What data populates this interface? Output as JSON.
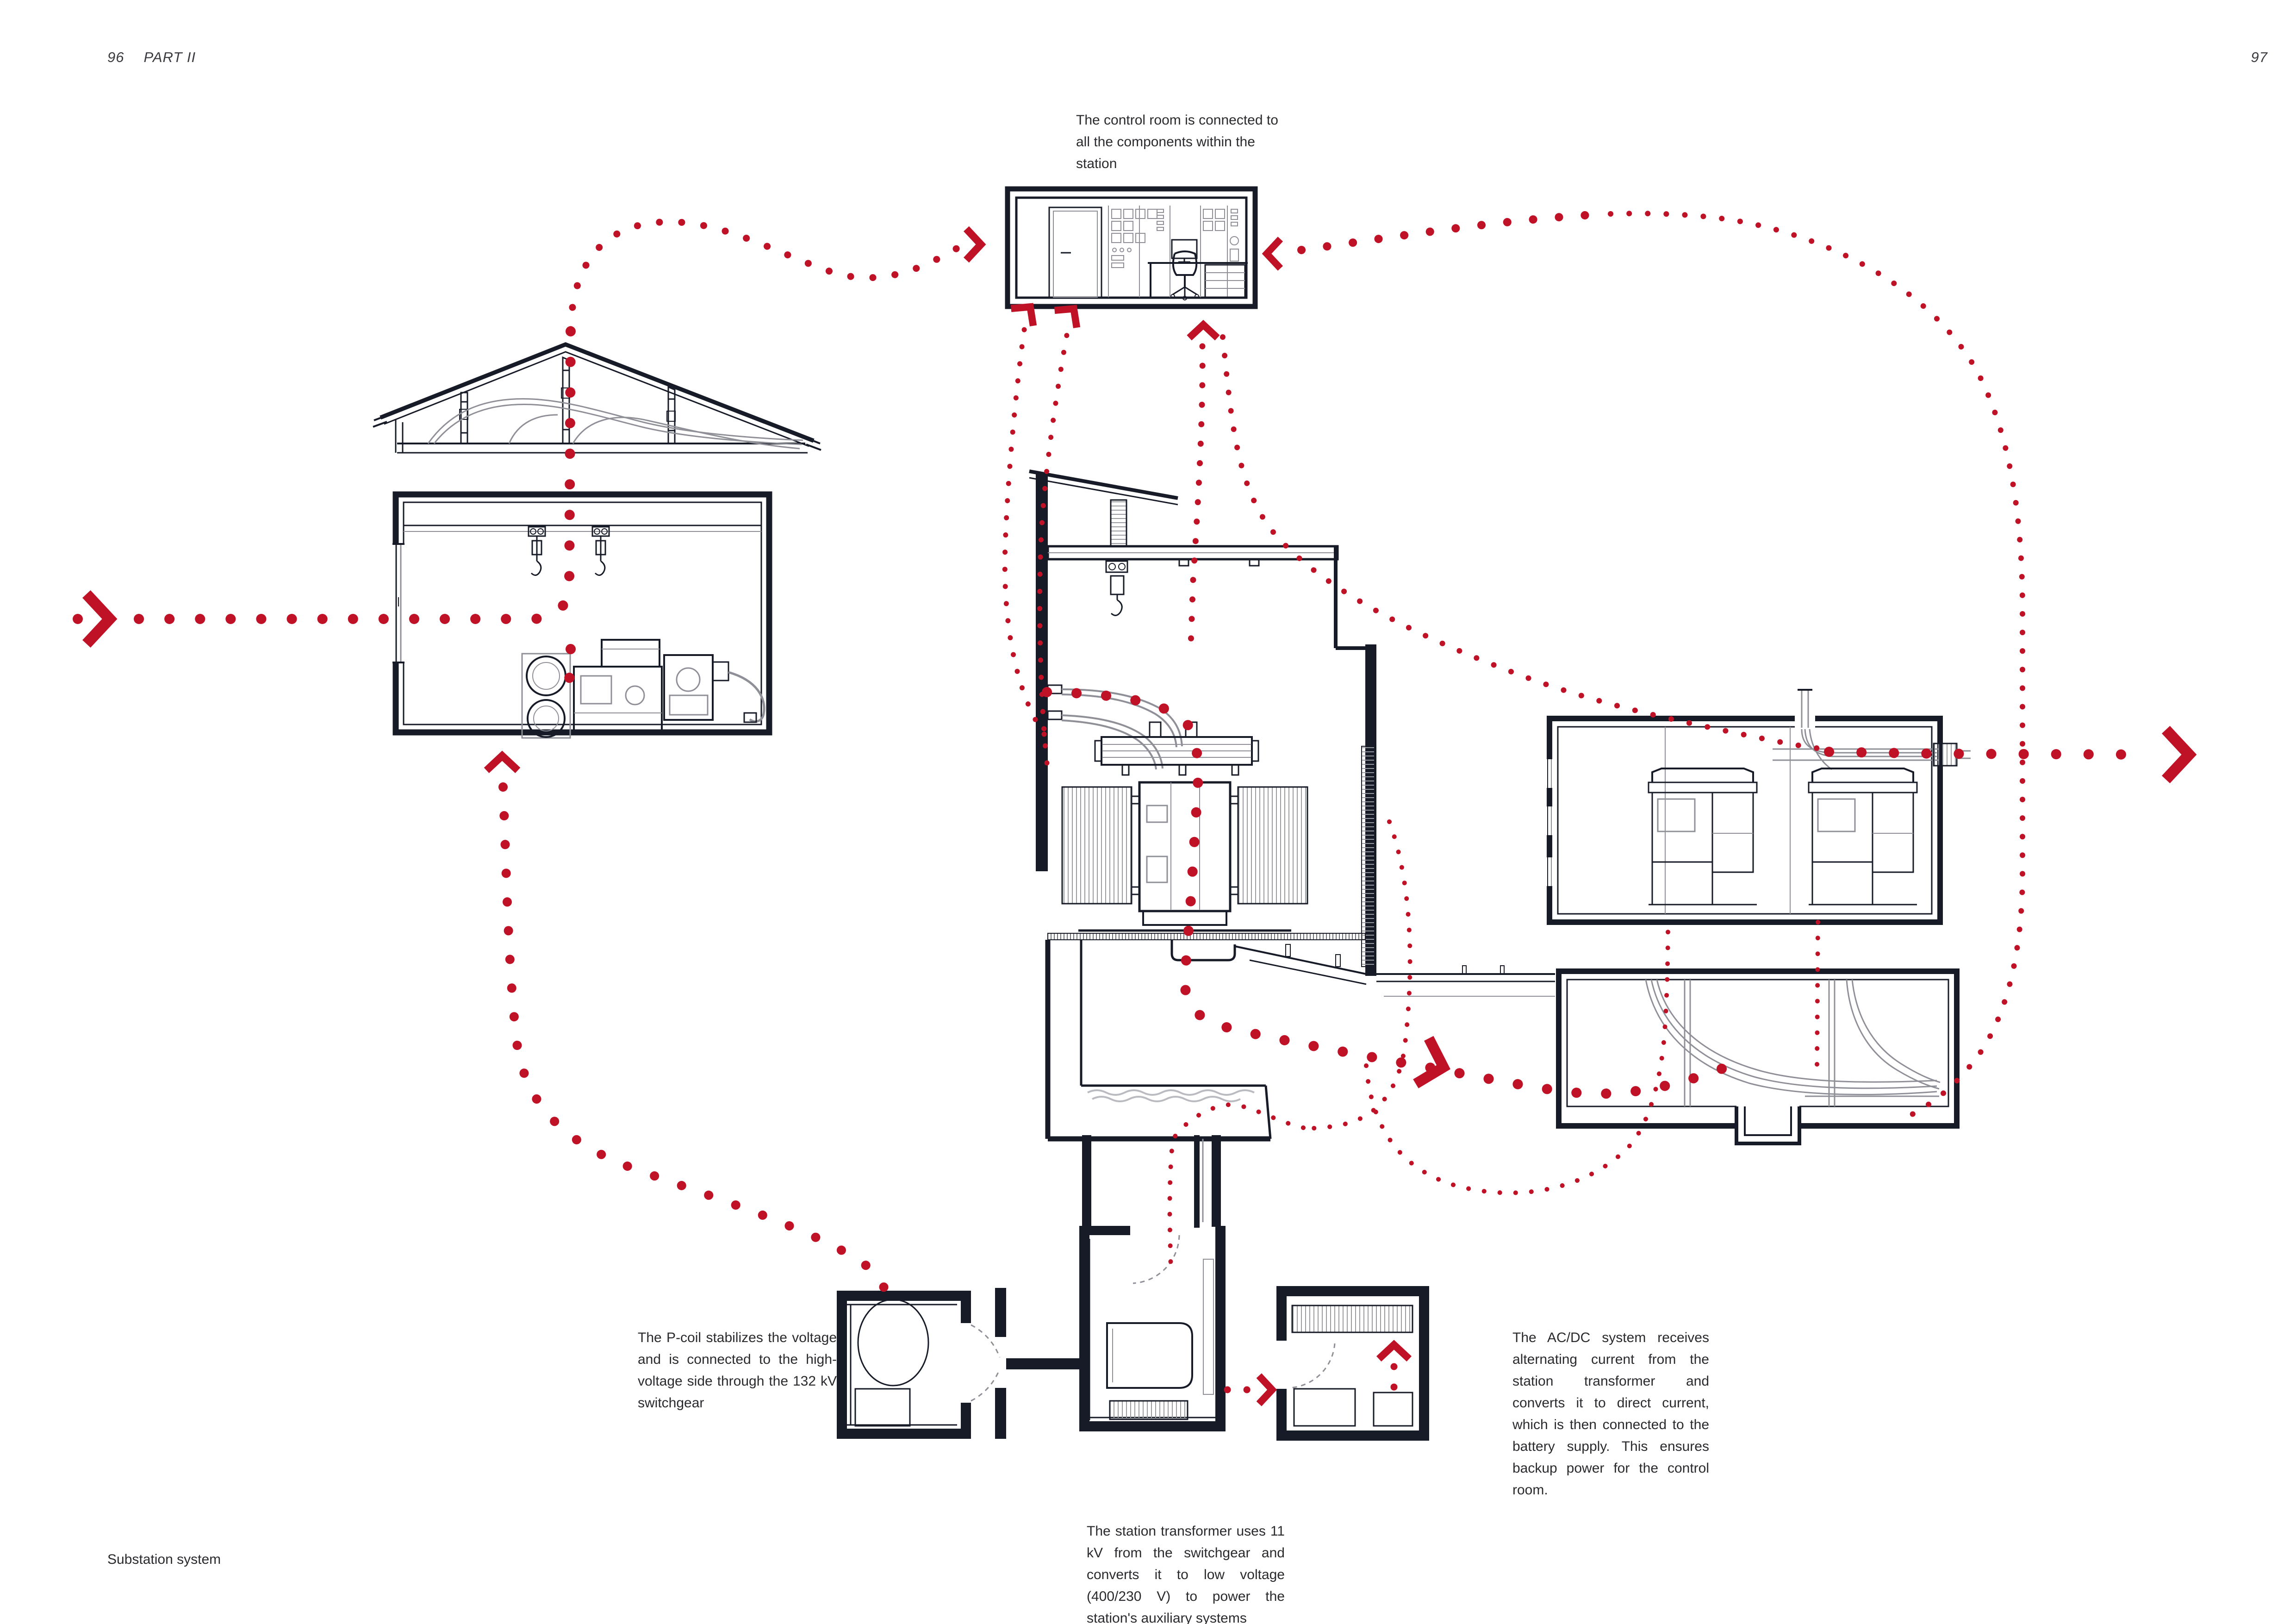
{
  "page": {
    "left_page_number": "96",
    "part_label": "PART II",
    "right_page_number": "97",
    "footer_label": "Substation system"
  },
  "captions": {
    "control_room": "The control room is connected to all the components within the station",
    "p_coil": "The P-coil stabilizes the voltage and is connected to the high-voltage side through the 132 kV switchgear",
    "station_transformer": "The station transformer uses 11 kV from the switchgear and converts it to low voltage (400/230 V) to power the station's auxiliary systems",
    "ac_dc": "The AC/DC system receives alternating current from the station transformer and converts it to direct current, which is then connected to the battery supply. This ensures backup power for the control room."
  },
  "colors": {
    "accent_red": "#c01226",
    "line_ink": "#171b27",
    "line_gray": "#8f9097",
    "line_light_gray": "#babbc1",
    "background": "#ffffff"
  },
  "diagram": {
    "drawings": [
      "attic-truss-section",
      "switchgear-hall-section",
      "control-room-section",
      "transformer-hall-section",
      "switchgear-room-plan",
      "cable-basement-section",
      "p-coil-room-plan",
      "station-transformer-room-plan",
      "ac-dc-room-plan"
    ],
    "flow_style": "dotted-red-arrows"
  }
}
